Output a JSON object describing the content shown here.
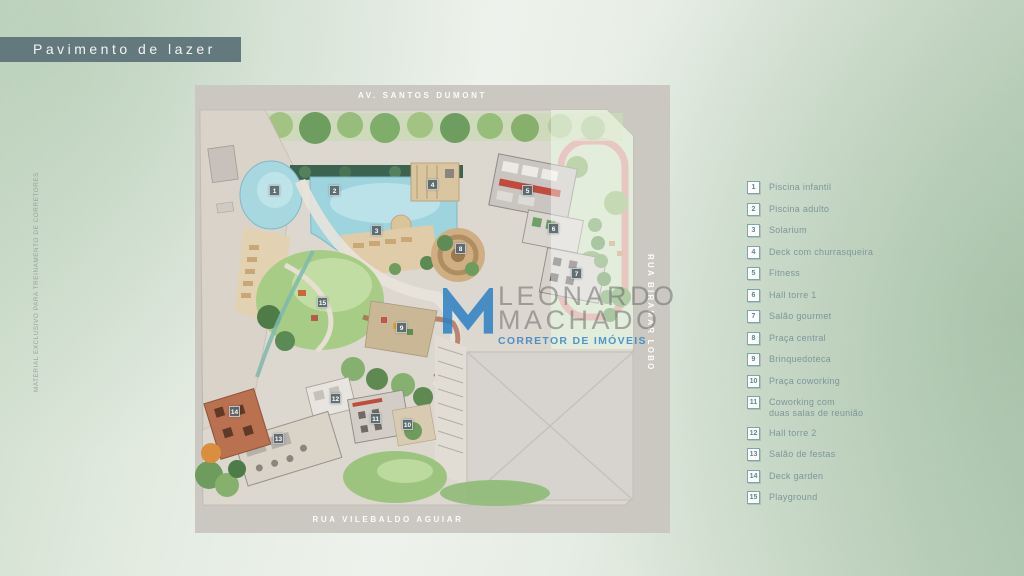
{
  "page": {
    "title_banner": "Pavimento de lazer"
  },
  "disclaimer": {
    "vertical_text": "MATERIAL EXCLUSIVO PARA TREINAMENTO DE CORRETORES"
  },
  "map": {
    "streets": {
      "top": "AV. SANTOS DUMONT",
      "bottom": "RUA VILEBALDO AGUIAR",
      "right": "RUA BIRAMAR LOBO"
    },
    "markers": [
      {
        "n": "1"
      },
      {
        "n": "2"
      },
      {
        "n": "3"
      },
      {
        "n": "4"
      },
      {
        "n": "5"
      },
      {
        "n": "6"
      },
      {
        "n": "7"
      },
      {
        "n": "8"
      },
      {
        "n": "9"
      },
      {
        "n": "10"
      },
      {
        "n": "11"
      },
      {
        "n": "12"
      },
      {
        "n": "13"
      },
      {
        "n": "14"
      },
      {
        "n": "15"
      }
    ]
  },
  "legend": {
    "items": [
      {
        "num": "1",
        "label": "Piscina infantil"
      },
      {
        "num": "2",
        "label": "Piscina adulto"
      },
      {
        "num": "3",
        "label": "Solarium"
      },
      {
        "num": "4",
        "label": "Deck com churrasqueira"
      },
      {
        "num": "5",
        "label": "Fitness"
      },
      {
        "num": "6",
        "label": "Hall torre 1"
      },
      {
        "num": "7",
        "label": "Salão gourmet"
      },
      {
        "num": "8",
        "label": "Praça central"
      },
      {
        "num": "9",
        "label": "Brinquedoteca"
      },
      {
        "num": "10",
        "label": "Praça coworking"
      },
      {
        "num": "11",
        "label": "Coworking com\nduas salas de reunião"
      },
      {
        "num": "12",
        "label": "Hall torre 2"
      },
      {
        "num": "13",
        "label": "Salão de festas"
      },
      {
        "num": "14",
        "label": "Deck garden"
      },
      {
        "num": "15",
        "label": "Playground"
      }
    ]
  },
  "watermark": {
    "line1": "LEONARDO",
    "line2": "MACHADO",
    "line3": "CORRETOR DE IMÓVEIS",
    "logo_icon": "m-monogram"
  },
  "colors": {
    "banner_bg": "#64797d",
    "street_band": "#cbc8c2",
    "pool_blue": "#9ed4de",
    "lawn_green": "#a7cc86",
    "deck_tan": "#e0cca8",
    "marker_bg": "#56656a",
    "legend_accent": "#5f858e",
    "watermark_blue": "#2c80c4"
  }
}
